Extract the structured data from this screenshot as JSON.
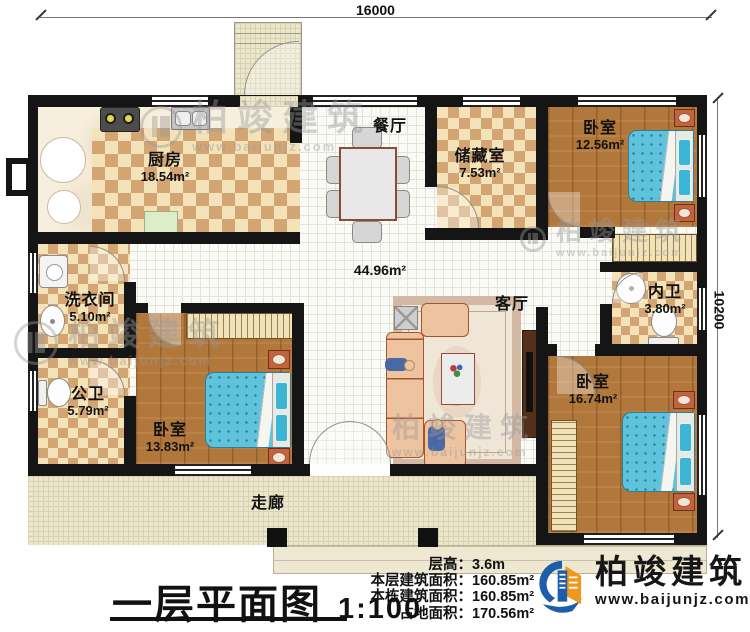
{
  "dimensions": {
    "top": "16000",
    "right": "10200"
  },
  "rooms": {
    "kitchen": {
      "name": "厨房",
      "area": "18.54m²"
    },
    "dining": {
      "name": "餐厅"
    },
    "storage": {
      "name": "储藏室",
      "area": "7.53m²"
    },
    "bedroom_top_right": {
      "name": "卧室",
      "area": "12.56m²"
    },
    "laundry": {
      "name": "洗衣间",
      "area": "5.10m²"
    },
    "open_area": {
      "area": "44.96m²"
    },
    "living": {
      "name": "客厅"
    },
    "inner_bath": {
      "name": "内卫",
      "area": "3.80m²"
    },
    "public_bath": {
      "name": "公卫",
      "area": "5.79m²"
    },
    "bedroom_bottom_left": {
      "name": "卧室",
      "area": "13.83m²"
    },
    "bedroom_bottom_right": {
      "name": "卧室",
      "area": "16.74m²"
    },
    "corridor": {
      "name": "走廊"
    }
  },
  "title": {
    "text": "一层平面图",
    "scale": "1:100"
  },
  "stats": [
    {
      "label": "层高：",
      "value": "3.6m"
    },
    {
      "label": "本层建筑面积：",
      "value": "160.85m²"
    },
    {
      "label": "本栋建筑面积：",
      "value": "160.85m²"
    },
    {
      "label": "占地面积：",
      "value": "170.56m²"
    }
  ],
  "brand": {
    "name": "柏竣建筑",
    "site": "www.baijunjz.com"
  },
  "watermark": {
    "text": "柏竣建筑",
    "site": "www.baijunjz.com"
  },
  "colors": {
    "wall": "#151515",
    "brand_blue": "#1f5dab",
    "brand_orange": "#f0981d",
    "bed_blue": "#5fc3dd",
    "tile_tan": "#d2a573",
    "wood": "#b2773b"
  }
}
